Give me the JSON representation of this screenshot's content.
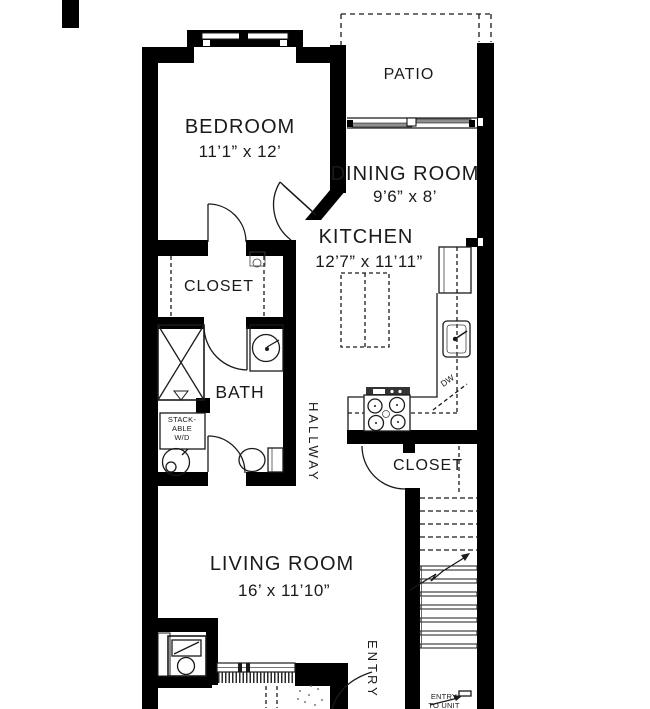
{
  "plan": {
    "rooms": {
      "bedroom": {
        "label": "BEDROOM",
        "dims": "11’1” x 12’"
      },
      "patio": {
        "label": "PATIO"
      },
      "dining": {
        "label": "DINING ROOM",
        "dims": "9’6” x 8’"
      },
      "kitchen": {
        "label": "KITCHEN",
        "dims": "12’7” x 11’11”"
      },
      "closet_main": {
        "label": "CLOSET"
      },
      "bath": {
        "label": "BATH"
      },
      "hallway": {
        "label": "HALLWAY"
      },
      "closet_entry": {
        "label": "CLOSET"
      },
      "living": {
        "label": "LIVING ROOM",
        "dims": "16’ x 11’10”"
      },
      "entry": {
        "label": "ENTRY"
      }
    },
    "fixtures": {
      "washer_dryer": [
        "STACK-",
        "ABLE",
        "W/D"
      ],
      "dishwasher": "DW"
    },
    "annotations": {
      "entry_to_unit_line1": "ENTRY",
      "entry_to_unit_line2": "TO UNIT"
    },
    "colors": {
      "wall": "#000000",
      "line": "#1a1a1a",
      "text": "#1a1a1a",
      "door_panel": "#8f8f8f",
      "background": "#ffffff"
    }
  }
}
